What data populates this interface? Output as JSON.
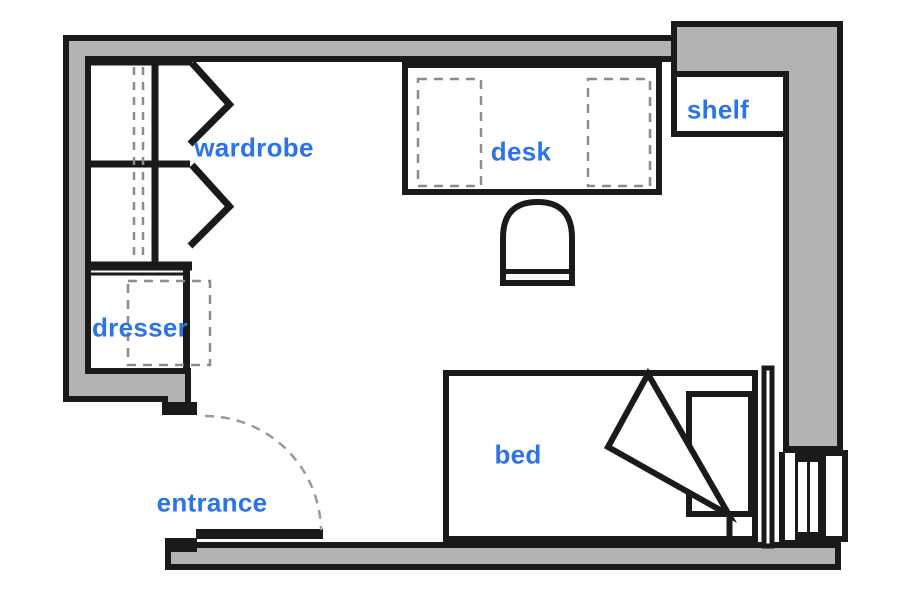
{
  "diagram": {
    "type": "floor-plan",
    "description": "single room floor plan with labeled furniture"
  },
  "labels": {
    "wardrobe": "wardrobe",
    "desk": "desk",
    "shelf": "shelf",
    "dresser": "dresser",
    "bed": "bed",
    "entrance": "entrance"
  },
  "colors": {
    "wall_gray": "#b3b3b3",
    "line_black": "#1a1a1a",
    "dash_gray": "#8c8c8c",
    "arc_gray": "#9a9a9a",
    "label_blue": "#2a73e8",
    "background": "#ffffff"
  },
  "elements": [
    "outer-walls",
    "wardrobe-with-bifold-doors",
    "hanging-rail-dashed",
    "dresser-with-open-drawer-dashed",
    "desk-with-two-underdesk-units-dashed",
    "desk-chair",
    "wall-shelf-niche",
    "bed-with-pillow-and-folded-blanket",
    "headboard",
    "radiator-window-unit",
    "entrance-door-leaf",
    "door-swing-arc-dashed"
  ]
}
